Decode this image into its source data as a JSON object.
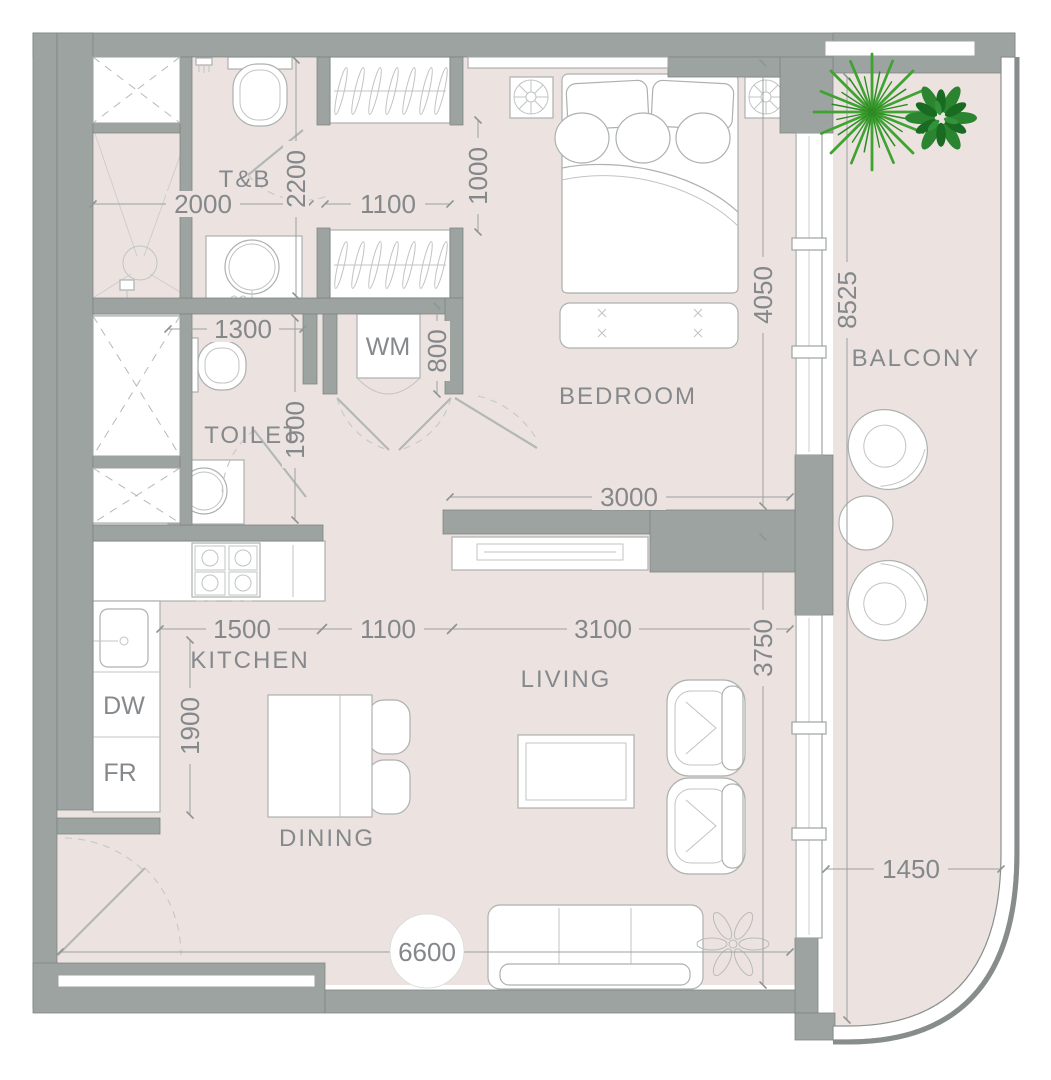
{
  "plan_title": "apartment-unit-floor-plan",
  "rooms": {
    "tb": "T&B",
    "toilet": "TOILET",
    "bedroom": "BEDROOM",
    "balcony": "BALCONY",
    "kitchen": "KITCHEN",
    "living": "LIVING",
    "dining": "DINING"
  },
  "appliances": {
    "washing_machine": "WM",
    "dishwasher": "DW",
    "fridge": "FR"
  },
  "dimensions_mm": {
    "tb_width": "2000",
    "tb_length": "2200",
    "hall_width": "1100",
    "hall_depth": "1000",
    "toilet_width": "1300",
    "toilet_length": "1900",
    "wm_niche": "800",
    "bedroom_width": "3000",
    "bedroom_length": "4050",
    "balcony_length": "8525",
    "balcony_width": "1450",
    "kitchen_run": "1500",
    "kitchen_pass": "1100",
    "kitchen_depth": "1900",
    "living_width": "3100",
    "living_length": "3750",
    "unit_width": "6600"
  },
  "colors": {
    "wall": "#9CA3A1",
    "floor": "#ECE3E0",
    "text": "#85898C",
    "palm_green": "#3FA331",
    "bush_green": "#24802B"
  }
}
